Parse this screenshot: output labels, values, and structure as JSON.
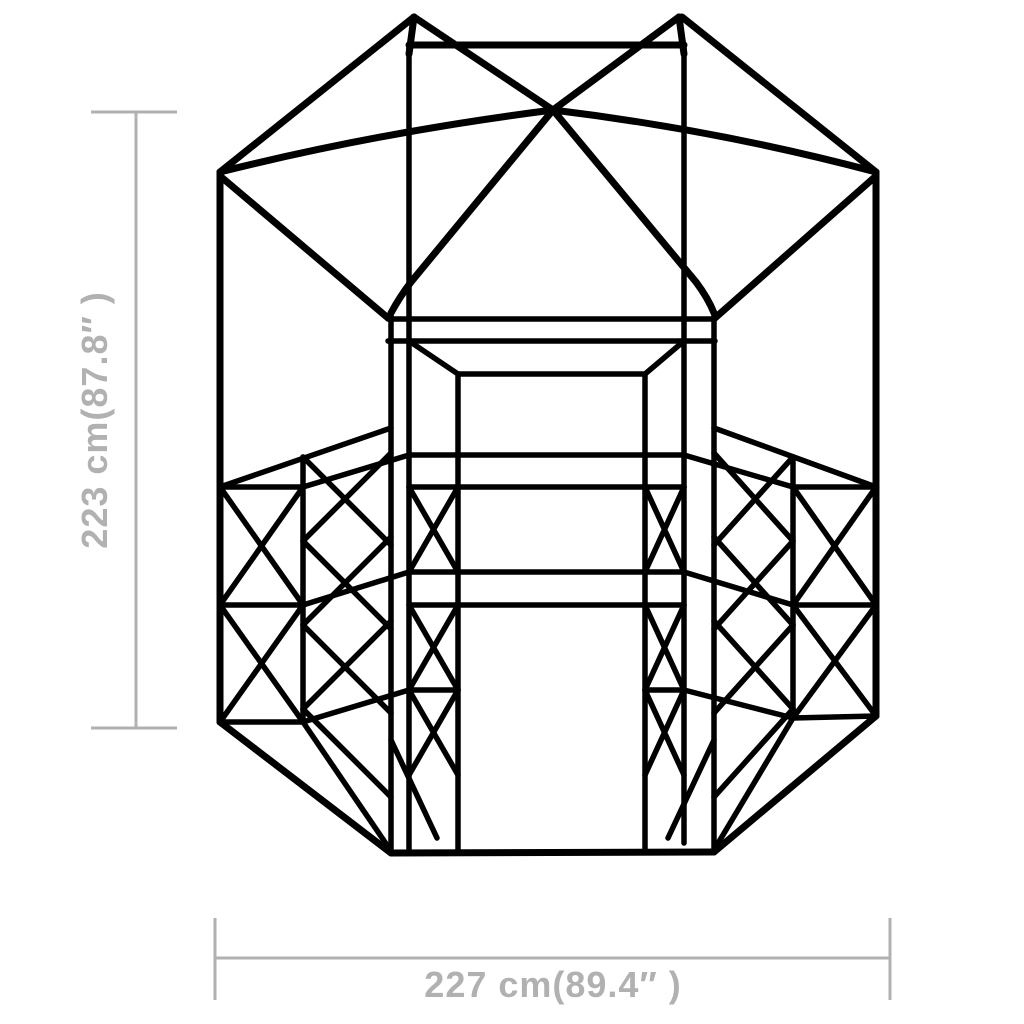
{
  "drawing": {
    "subject": "Hexagonal greenhouse frame wireframe, front elevation"
  },
  "dimensions": {
    "height_label": "223 cm(87.8″ )",
    "width_label": "227 cm(89.4″ )"
  },
  "colors": {
    "line": "#000000",
    "dimension_line": "#b1b1b1",
    "dimension_text": "#b1b1b1",
    "background": "#ffffff"
  }
}
